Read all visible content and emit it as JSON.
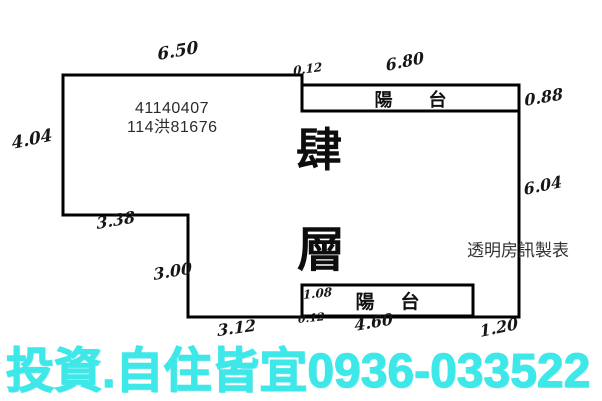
{
  "floor_plan": {
    "case_number": "41140407",
    "registration_number": "114洪81676",
    "floor_title": {
      "char1": "肆",
      "char2": "層"
    },
    "balcony_top": {
      "label": "陽台"
    },
    "balcony_bottom": {
      "label": "陽台"
    },
    "maker_credit": "透明房訊製表",
    "dimensions": {
      "top_width": "6.50",
      "top_step": "0.12",
      "top_balcony_width": "6.80",
      "top_balcony_depth": "0.88",
      "right_height": "6.04",
      "left_height": "4.04",
      "step_width": "3.38",
      "step_height": "3.00",
      "bottom_left_width": "3.12",
      "bottom_balcony_depth": "1.08",
      "bottom_step": "0.12",
      "bottom_balcony_width": "4.60",
      "bottom_right_width": "1.20"
    }
  },
  "banner": {
    "text": "投資.自住皆宜0936-033522",
    "color": "#3ee8e8"
  },
  "colors": {
    "plan_line": "#000000",
    "typed_text": "#2b2b2b"
  }
}
